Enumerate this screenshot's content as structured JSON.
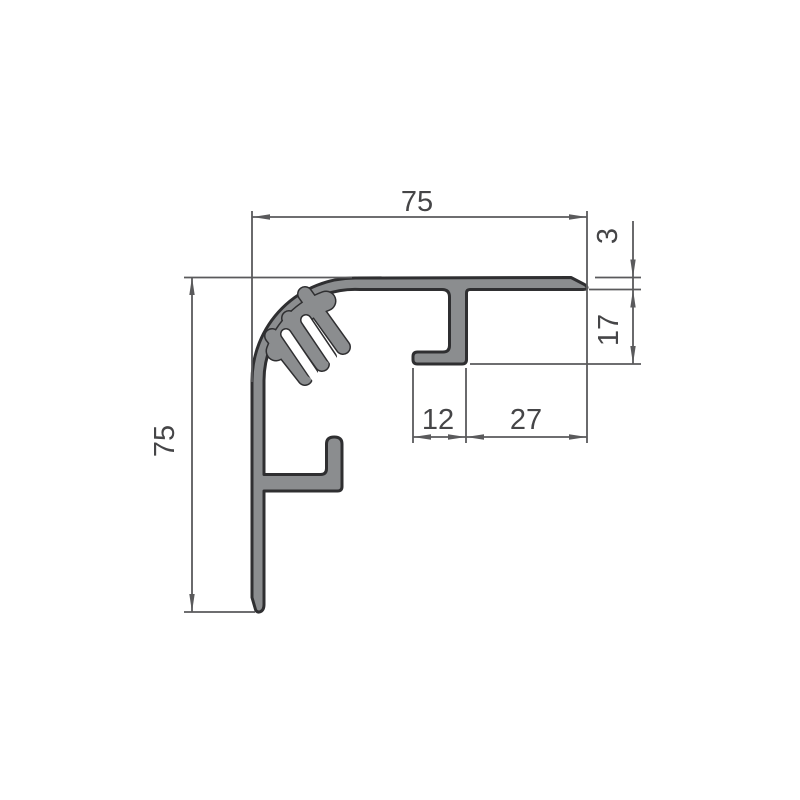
{
  "drawing": {
    "labels": {
      "width_top": "75",
      "height_left": "75",
      "flange_thickness": "3",
      "channel_depth": "17",
      "hook_width": "12",
      "flange_extension": "27"
    },
    "colors": {
      "profile_fill": "#8b8d8f",
      "profile_outline": "#2f2f31",
      "dim_line": "#5a5a5c",
      "dim_text": "#454547"
    }
  }
}
